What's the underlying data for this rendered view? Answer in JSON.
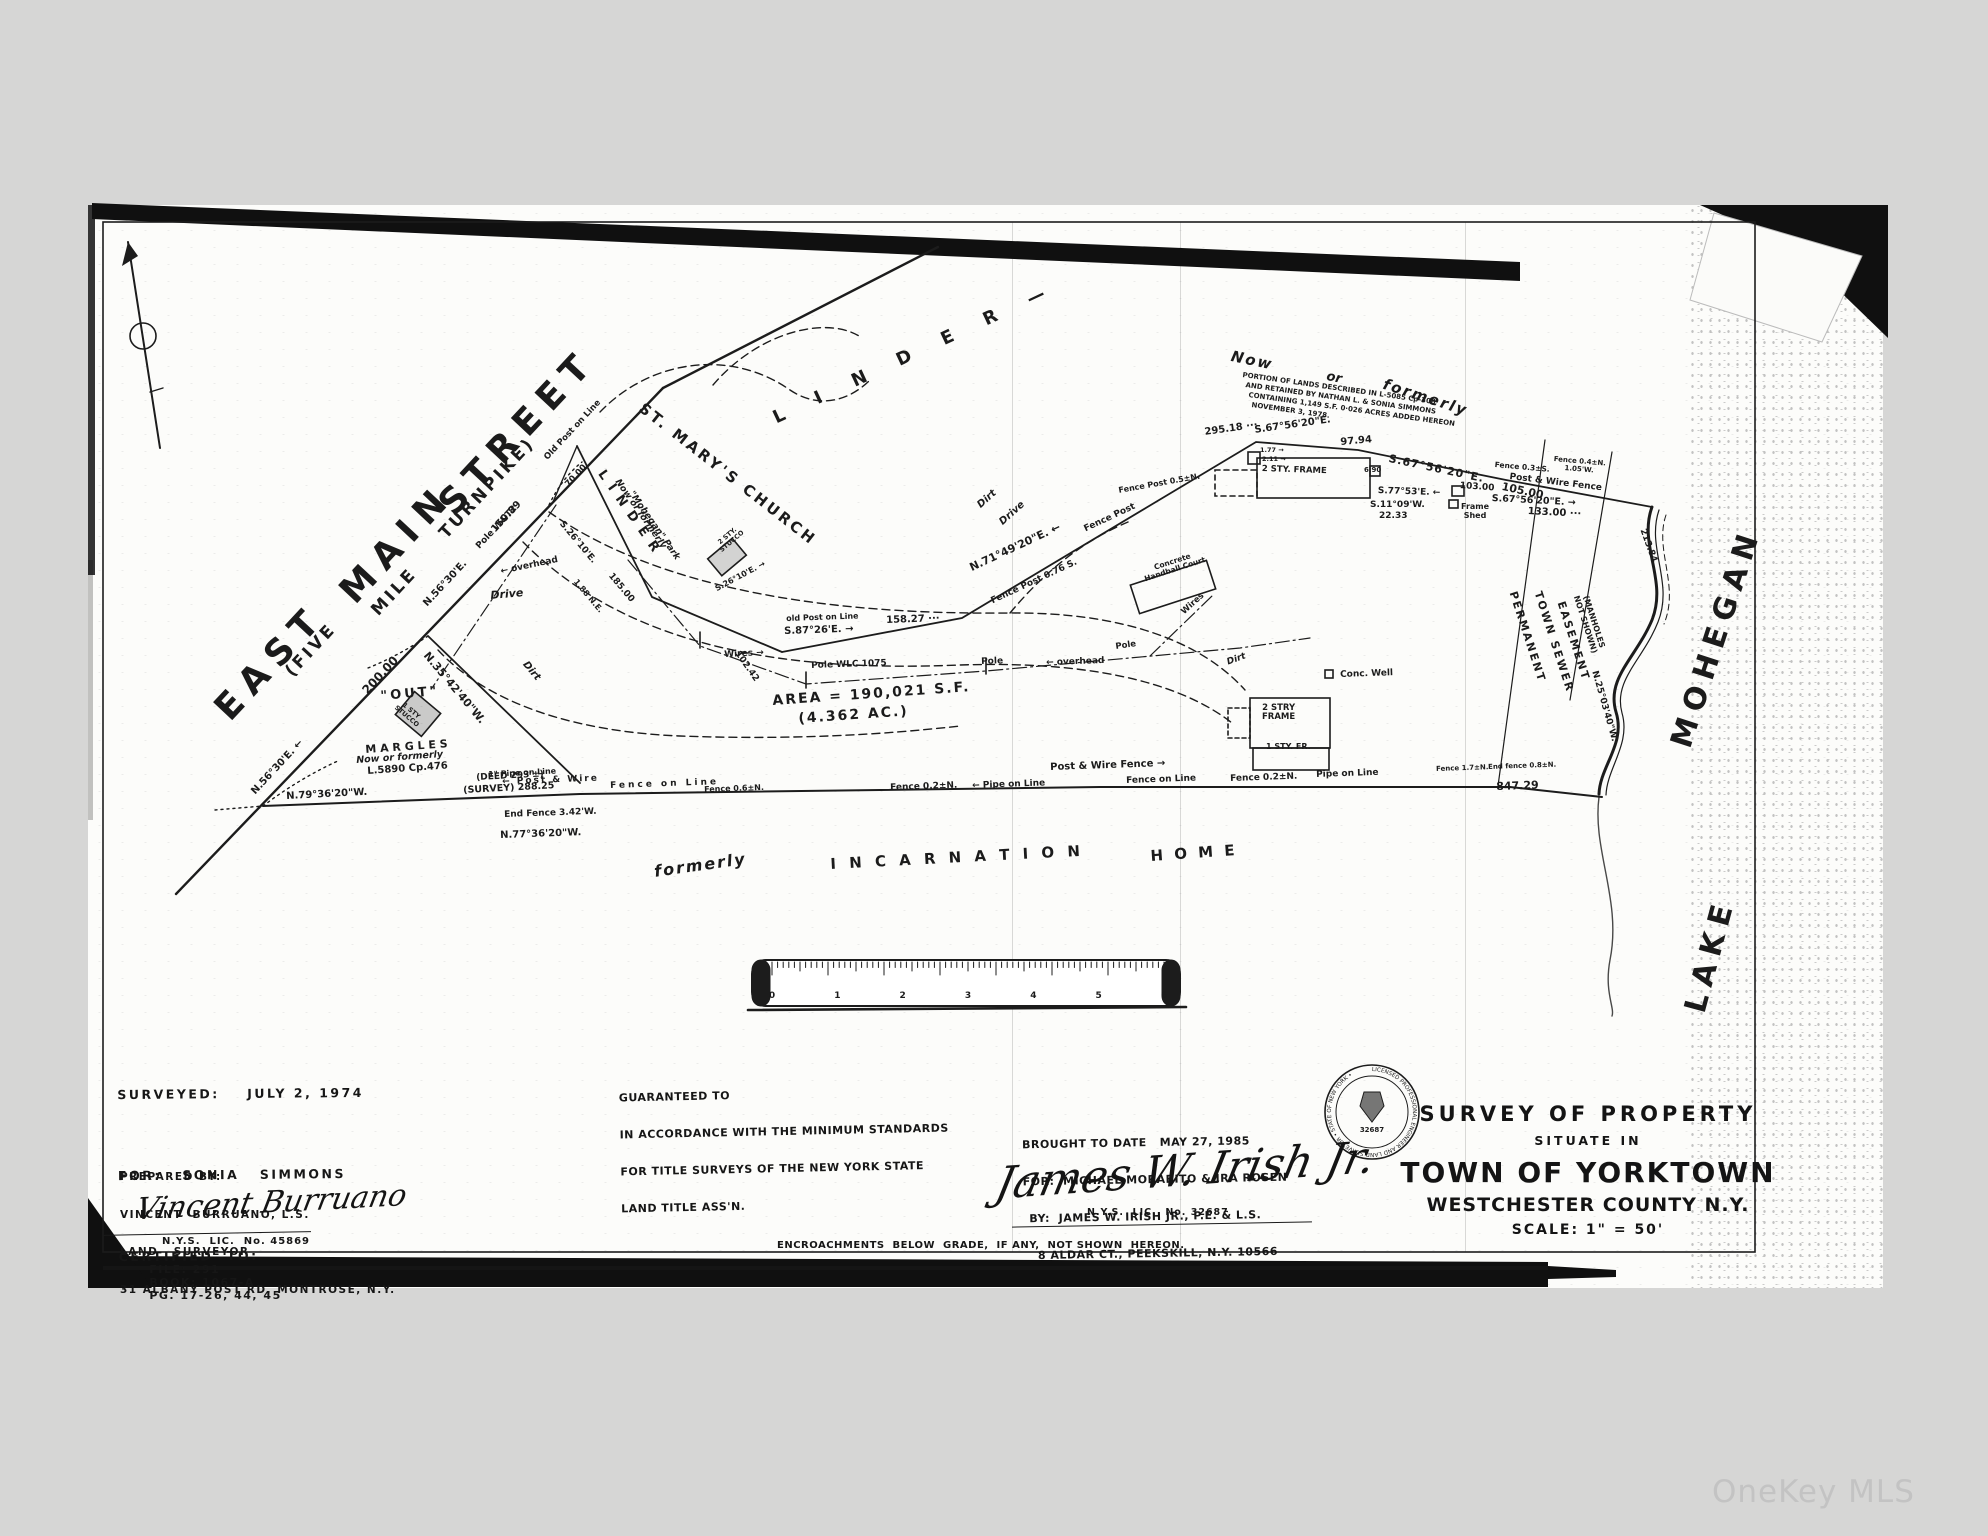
{
  "watermark": "OneKey MLS",
  "blocks": {
    "surveyed": {
      "lines": [
        "SURVEYED:    JULY 2, 1974",
        "FOR:   SONIA   SIMMONS",
        "CERTIFIED  TO:"
      ]
    },
    "prepared": {
      "lines": [
        "PREPARED BY:",
        "VINCENT  BURRUANO, L.S.",
        "LAND   SURVEYOR",
        "31 ALBANY POST RD, MONTROSE, N.Y."
      ]
    },
    "surveyor_signature": {
      "name": "Vincent Burruano",
      "license": "N.Y.S.  LIC.  No. 45869"
    },
    "file_line": {
      "file": "FILE: 291",
      "book": "BOOK: 1067-A",
      "pages": "PG. 17-26, 44, 45"
    },
    "guaranteed": {
      "lines": [
        "GUARANTEED TO",
        "IN ACCORDANCE WITH THE MINIMUM STANDARDS",
        "FOR TITLE SURVEYS OF THE NEW YORK STATE",
        "LAND TITLE ASS'N."
      ]
    },
    "brought": {
      "lines": [
        "BROUGHT TO DATE   MAY 27, 1985",
        "FOR:  MICHAEL MORABITO & IRA ROSEN",
        "BY:  JAMES W. IRISH JR., P.E. & L.S.",
        "8 ALDAR CT., PEEKSKILL, N.Y. 10566"
      ]
    },
    "engineer_signature": {
      "name": "James W. Irish Jr.",
      "license": "N.Y.S.  LIC.  No. 32687"
    },
    "encroachments_note": "ENCROACHMENTS  BELOW  GRADE,  IF ANY,  NOT SHOWN  HEREON.",
    "title": {
      "line1": "SURVEY  OF  PROPERTY",
      "line2": "SITUATE    IN",
      "line3": "TOWN  OF  YORKTOWN",
      "line4": "WESTCHESTER   COUNTY   N.Y.",
      "line5": "SCALE:  1\" =  50'"
    },
    "seal": {
      "ring_text": "LICENSED PROFESSIONAL ENGINEER AND LAND SURVEYOR • STATE OF NEW YORK •",
      "number": "32687"
    }
  },
  "ruler": {
    "numbers": [
      "0",
      "1",
      "2",
      "3",
      "4",
      "5",
      "6"
    ]
  },
  "map_labels": [
    {
      "n": "street-name-east",
      "t": "EAST",
      "x": 208,
      "y": 702,
      "r": -47,
      "s": 36,
      "ls": 10
    },
    {
      "n": "street-name-main",
      "t": "MAIN",
      "x": 333,
      "y": 585,
      "r": -47,
      "s": 36,
      "ls": 10
    },
    {
      "n": "street-name-street",
      "t": "STREET",
      "x": 432,
      "y": 497,
      "r": -47,
      "s": 36,
      "ls": 10
    },
    {
      "n": "street-sub-five",
      "t": "(FIVE",
      "x": 282,
      "y": 668,
      "r": -47,
      "s": 17,
      "ls": 3
    },
    {
      "n": "street-sub-mile",
      "t": "MILE",
      "x": 368,
      "y": 607,
      "r": -47,
      "s": 17,
      "ls": 3
    },
    {
      "n": "street-sub-turnpike",
      "t": "TURNPIKE)",
      "x": 436,
      "y": 530,
      "r": -47,
      "s": 17,
      "ls": 3
    },
    {
      "n": "bearing-label",
      "t": "N.56°30'E. ←",
      "x": 250,
      "y": 790,
      "r": -47,
      "s": 10
    },
    {
      "n": "bearing-label",
      "t": "N.56°30'E.",
      "x": 422,
      "y": 602,
      "r": -47,
      "s": 10
    },
    {
      "n": "distance-label",
      "t": "200.00",
      "x": 360,
      "y": 688,
      "r": -47,
      "s": 12
    },
    {
      "n": "pole-note",
      "t": "Pole W&T2",
      "x": 475,
      "y": 545,
      "r": -47,
      "s": 9
    },
    {
      "n": "distance-label",
      "t": "150.89",
      "x": 490,
      "y": 528,
      "r": -47,
      "s": 10
    },
    {
      "n": "bearing-label",
      "t": "N.35°42'40\"W.",
      "x": 430,
      "y": 650,
      "r": 50,
      "s": 11
    },
    {
      "n": "out-parcel-label",
      "t": "\"OUT\"",
      "x": 380,
      "y": 690,
      "r": -5,
      "s": 13,
      "ls": 3
    },
    {
      "n": "building-label-stucco1",
      "t": "1 STY\nSTUCCO",
      "x": 402,
      "y": 699,
      "r": 40,
      "s": 6.5
    },
    {
      "n": "owner-label-margles",
      "t": "M A R G L E S",
      "x": 365,
      "y": 744,
      "r": -4,
      "s": 11
    },
    {
      "n": "owner-note",
      "t": "Now  or  formerly",
      "x": 356,
      "y": 756,
      "r": -4,
      "s": 9.5,
      "i": 1
    },
    {
      "n": "deed-ref",
      "t": "L.5890  Cp.476",
      "x": 367,
      "y": 767,
      "r": -4,
      "s": 10
    },
    {
      "n": "deed-note",
      "t": "(DEED 293'±)",
      "x": 476,
      "y": 774,
      "r": -3,
      "s": 9
    },
    {
      "n": "survey-note",
      "t": "(SURVEY)  288.25",
      "x": 463,
      "y": 786,
      "r": -3,
      "s": 9.5
    },
    {
      "n": "bearing-label",
      "t": "N.79°36'20\"W.",
      "x": 286,
      "y": 792,
      "r": -3,
      "s": 10
    },
    {
      "n": "fence-note",
      "t": "End Fence 3.42'W.",
      "x": 504,
      "y": 811,
      "r": -2,
      "s": 9
    },
    {
      "n": "bearing-label",
      "t": "N.77°36'20\"W.",
      "x": 500,
      "y": 831,
      "r": -2,
      "s": 10
    },
    {
      "n": "post-note",
      "t": "Old Post on Line",
      "x": 543,
      "y": 456,
      "r": -47,
      "s": 8.5
    },
    {
      "n": "distance-label",
      "t": "70.00",
      "x": 564,
      "y": 483,
      "r": -47,
      "s": 8.5
    },
    {
      "n": "bearing-label",
      "t": "S.26°10'E.",
      "x": 564,
      "y": 520,
      "r": 50,
      "s": 9
    },
    {
      "n": "fence-note",
      "t": "1.88 N.E.",
      "x": 578,
      "y": 578,
      "r": 50,
      "s": 8
    },
    {
      "n": "distance-label",
      "t": "185.00",
      "x": 613,
      "y": 572,
      "r": 50,
      "s": 9
    },
    {
      "n": "drive-label",
      "t": "Dirt",
      "x": 528,
      "y": 660,
      "r": 50,
      "s": 10,
      "i": 1
    },
    {
      "n": "drive-label",
      "t": "Drive",
      "x": 490,
      "y": 590,
      "r": -5,
      "s": 11,
      "i": 1
    },
    {
      "n": "church-label",
      "t": "ST. MARY'S  CHURCH",
      "x": 646,
      "y": 400,
      "r": 38,
      "s": 15,
      "ls": 3
    },
    {
      "n": "owner-label-linder",
      "t": "L I N D E R",
      "x": 606,
      "y": 468,
      "r": 55,
      "s": 13,
      "ls": 2
    },
    {
      "n": "owner-note",
      "t": "Now or formerly",
      "x": 620,
      "y": 478,
      "r": 55,
      "s": 9,
      "i": 1
    },
    {
      "n": "owner-note",
      "t": "\"Mohegan\" Park",
      "x": 634,
      "y": 490,
      "r": 55,
      "s": 9,
      "i": 1
    },
    {
      "n": "building-label-stucco2",
      "t": "2 STY.\nSTUCCO",
      "x": 714,
      "y": 543,
      "r": -40,
      "s": 6.5
    },
    {
      "n": "bearing-label",
      "t": "S.26°10'E. →",
      "x": 714,
      "y": 586,
      "r": -28,
      "s": 8
    },
    {
      "n": "owner-label-linder-2",
      "t": "L  I  N  D  E  R   —",
      "x": 770,
      "y": 410,
      "r": -25,
      "s": 18,
      "ls": 14
    },
    {
      "n": "bearing-label",
      "t": "S.87°26'E. →",
      "x": 784,
      "y": 627,
      "r": -2,
      "s": 10
    },
    {
      "n": "post-note",
      "t": "old Post on Line",
      "x": 786,
      "y": 615,
      "r": -2,
      "s": 8
    },
    {
      "n": "distance-label",
      "t": "102.42",
      "x": 740,
      "y": 650,
      "r": 55,
      "s": 9
    },
    {
      "n": "wire-note",
      "t": "Wires →",
      "x": 724,
      "y": 651,
      "r": -3,
      "s": 9
    },
    {
      "n": "pole-note",
      "t": "Pole WLC 1075",
      "x": 811,
      "y": 662,
      "r": -2,
      "s": 9
    },
    {
      "n": "pole-note",
      "t": "Pole",
      "x": 981,
      "y": 658,
      "r": -2,
      "s": 9
    },
    {
      "n": "wire-note",
      "t": "← overhead",
      "x": 1046,
      "y": 659,
      "r": -2,
      "s": 9
    },
    {
      "n": "wire-note",
      "t": "← overhead",
      "x": 500,
      "y": 568,
      "r": -12,
      "s": 9
    },
    {
      "n": "area-label",
      "t": "AREA = 190,021 S.F.",
      "x": 772,
      "y": 694,
      "r": -4,
      "s": 14,
      "ls": 2
    },
    {
      "n": "area-label-acres",
      "t": "(4.362 AC.)",
      "x": 798,
      "y": 712,
      "r": -4,
      "s": 14,
      "ls": 2
    },
    {
      "n": "bearing-label",
      "t": "N.71°49'20\"E. ←",
      "x": 968,
      "y": 563,
      "r": -25,
      "s": 11
    },
    {
      "n": "fence-note",
      "t": "Fence Post",
      "x": 1083,
      "y": 526,
      "r": -25,
      "s": 9
    },
    {
      "n": "fence-note",
      "t": "Fence Post 0.76 S.",
      "x": 990,
      "y": 598,
      "r": -25,
      "s": 9
    },
    {
      "n": "distance-label",
      "t": "158.27 ···",
      "x": 886,
      "y": 616,
      "r": -2,
      "s": 10
    },
    {
      "n": "handball-label",
      "t": "Concrete\nHandball Court",
      "x": 1141,
      "y": 568,
      "r": -18,
      "s": 7.5
    },
    {
      "n": "wire-note",
      "t": "Wires",
      "x": 1180,
      "y": 610,
      "r": -42,
      "s": 8.5
    },
    {
      "n": "pole-note",
      "t": "Pole",
      "x": 1115,
      "y": 643,
      "r": -8,
      "s": 8.5
    },
    {
      "n": "drive-label",
      "t": "Dirt",
      "x": 976,
      "y": 503,
      "r": -42,
      "s": 10,
      "i": 1
    },
    {
      "n": "drive-label",
      "t": "Drive",
      "x": 998,
      "y": 520,
      "r": -42,
      "s": 10,
      "i": 1
    },
    {
      "n": "owner-note",
      "t": "Now",
      "x": 1233,
      "y": 348,
      "r": 12,
      "s": 15,
      "i": 1,
      "ls": 2
    },
    {
      "n": "owner-note",
      "t": "or",
      "x": 1328,
      "y": 370,
      "r": 12,
      "s": 13,
      "i": 1
    },
    {
      "n": "owner-note",
      "t": "formerly",
      "x": 1386,
      "y": 376,
      "r": 18,
      "s": 15,
      "i": 1,
      "ls": 2
    },
    {
      "n": "parcel-note",
      "t": "PORTION OF LANDS DESCRIBED IN L-5085 Cp-308",
      "x": 1243,
      "y": 372,
      "r": 8,
      "s": 7
    },
    {
      "n": "parcel-note",
      "t": "AND RETAINED BY NATHAN L. & SONIA SIMMONS",
      "x": 1246,
      "y": 382,
      "r": 8,
      "s": 7
    },
    {
      "n": "parcel-note",
      "t": "CONTAINING 1,149 S.F.  0·026 ACRES ADDED HEREON",
      "x": 1249,
      "y": 392,
      "r": 8,
      "s": 7
    },
    {
      "n": "parcel-note",
      "t": "NOVEMBER 3, 1978.",
      "x": 1252,
      "y": 402,
      "r": 8,
      "s": 7
    },
    {
      "n": "distance-label",
      "t": "295.18 ···",
      "x": 1204,
      "y": 428,
      "r": -8,
      "s": 10
    },
    {
      "n": "bearing-label",
      "t": "S.67°56'20\"E.",
      "x": 1254,
      "y": 426,
      "r": -8,
      "s": 10
    },
    {
      "n": "distance-label",
      "t": "97.94",
      "x": 1340,
      "y": 438,
      "r": -5,
      "s": 10
    },
    {
      "n": "bearing-label",
      "t": "S.67°56'20\"E.",
      "x": 1390,
      "y": 453,
      "r": 12,
      "s": 11,
      "ls": 1
    },
    {
      "n": "distance-label",
      "t": "105.00",
      "x": 1503,
      "y": 481,
      "r": 12,
      "s": 11
    },
    {
      "n": "distance-label",
      "t": "103.00",
      "x": 1460,
      "y": 482,
      "r": 4,
      "s": 9
    },
    {
      "n": "bearing-label",
      "t": "S.77°53'E. ←",
      "x": 1378,
      "y": 487,
      "r": 2,
      "s": 9
    },
    {
      "n": "bearing-label",
      "t": "S.11°09'W.",
      "x": 1370,
      "y": 501,
      "r": 0,
      "s": 9
    },
    {
      "n": "distance-label",
      "t": "22.33",
      "x": 1379,
      "y": 512,
      "r": 0,
      "s": 9
    },
    {
      "n": "building-label-frame1",
      "t": "2 STY. FRAME",
      "x": 1262,
      "y": 465,
      "r": 2,
      "s": 8.5
    },
    {
      "n": "building-label-shed",
      "t": "Frame\nShed",
      "x": 1461,
      "y": 503,
      "r": 0,
      "s": 8
    },
    {
      "n": "offset-note",
      "t": "1.77 →",
      "x": 1260,
      "y": 447,
      "r": 0,
      "s": 6.5
    },
    {
      "n": "offset-note",
      "t": "2.11 →",
      "x": 1262,
      "y": 456,
      "r": 0,
      "s": 6.5
    },
    {
      "n": "offset-note",
      "t": "6.90",
      "x": 1364,
      "y": 467,
      "r": 0,
      "s": 7
    },
    {
      "n": "fence-note",
      "t": "Fence 0.3±S.",
      "x": 1495,
      "y": 461,
      "r": 5,
      "s": 7.5
    },
    {
      "n": "fence-note",
      "t": "Fence 0.4±N.\n1.05'W.",
      "x": 1554,
      "y": 456,
      "r": 5,
      "s": 7
    },
    {
      "n": "fence-note",
      "t": "Post & Wire Fence",
      "x": 1510,
      "y": 473,
      "r": 7,
      "s": 9
    },
    {
      "n": "bearing-label",
      "t": "S.67°56'20\"E. →",
      "x": 1492,
      "y": 494,
      "r": 3,
      "s": 9.5
    },
    {
      "n": "distance-label",
      "t": "133.00 ···",
      "x": 1528,
      "y": 507,
      "r": 3,
      "s": 10
    },
    {
      "n": "distance-label",
      "t": "213.84",
      "x": 1646,
      "y": 528,
      "r": 70,
      "s": 9
    },
    {
      "n": "easement-label",
      "t": "PERMANENT",
      "x": 1518,
      "y": 590,
      "r": 72,
      "s": 11,
      "ls": 2
    },
    {
      "n": "easement-label",
      "t": "TOWN  SEWER",
      "x": 1543,
      "y": 590,
      "r": 72,
      "s": 11,
      "ls": 2
    },
    {
      "n": "easement-label",
      "t": "EASEMENT",
      "x": 1566,
      "y": 600,
      "r": 72,
      "s": 11,
      "ls": 2
    },
    {
      "n": "easement-label",
      "t": "(MANHOLES\nNOT SHOWN)",
      "x": 1588,
      "y": 592,
      "r": 72,
      "s": 8
    },
    {
      "n": "bearing-label",
      "t": "N.25°03'40\"W.",
      "x": 1598,
      "y": 670,
      "r": 74,
      "s": 9
    },
    {
      "n": "lake-name-mohegan",
      "t": "MOHEGAN",
      "x": 1666,
      "y": 742,
      "r": -72,
      "s": 30,
      "ls": 8
    },
    {
      "n": "lake-name-lake",
      "t": "LAKE",
      "x": 1680,
      "y": 1008,
      "r": -75,
      "s": 30,
      "ls": 8
    },
    {
      "n": "distance-label",
      "t": "847.29",
      "x": 1496,
      "y": 781,
      "r": -2,
      "s": 11
    },
    {
      "n": "fence-note",
      "t": "End fence 0.8±N.",
      "x": 1488,
      "y": 764,
      "r": -2,
      "s": 7
    },
    {
      "n": "fence-note",
      "t": "Fence 1.7±N.",
      "x": 1436,
      "y": 766,
      "r": -2,
      "s": 7
    },
    {
      "n": "fence-note",
      "t": "Post  &  Wire  Fence →",
      "x": 1050,
      "y": 763,
      "r": -2,
      "s": 10
    },
    {
      "n": "fence-note",
      "t": "Fence on Line",
      "x": 1126,
      "y": 777,
      "r": -2,
      "s": 9
    },
    {
      "n": "fence-note",
      "t": "Pipe on Line",
      "x": 1316,
      "y": 771,
      "r": -2,
      "s": 9
    },
    {
      "n": "fence-note",
      "t": "Fence 0.2±N.",
      "x": 1230,
      "y": 775,
      "r": -2,
      "s": 9
    },
    {
      "n": "fence-note",
      "t": "← Pipe on Line",
      "x": 972,
      "y": 782,
      "r": -2,
      "s": 9
    },
    {
      "n": "fence-note",
      "t": "Fence 0.2±N.",
      "x": 890,
      "y": 784,
      "r": -2,
      "s": 9
    },
    {
      "n": "fence-note",
      "t": "Fence   on   Line",
      "x": 610,
      "y": 782,
      "r": -2,
      "s": 9,
      "ls": 3
    },
    {
      "n": "fence-note",
      "t": "← Post  &  Wire",
      "x": 502,
      "y": 778,
      "r": -2,
      "s": 9,
      "ls": 2
    },
    {
      "n": "fence-note",
      "t": "1\" Pipe on Line",
      "x": 488,
      "y": 771,
      "r": -3,
      "s": 8
    },
    {
      "n": "fence-note",
      "t": "Fence 0.6±N.",
      "x": 704,
      "y": 786,
      "r": -2,
      "s": 8
    },
    {
      "n": "former-owner",
      "t": "formerly",
      "x": 653,
      "y": 863,
      "r": -8,
      "s": 16,
      "i": 1,
      "ls": 2
    },
    {
      "n": "former-owner",
      "t": "I N C A R N A T I O N",
      "x": 830,
      "y": 856,
      "r": -3,
      "s": 15,
      "ls": 4
    },
    {
      "n": "former-owner",
      "t": "H O M E",
      "x": 1150,
      "y": 848,
      "r": -4,
      "s": 15,
      "ls": 3
    },
    {
      "n": "well-note",
      "t": "Conc. Well",
      "x": 1340,
      "y": 671,
      "r": -2,
      "s": 9
    },
    {
      "n": "building-label-frame2",
      "t": "2 STRY\nFRAME",
      "x": 1262,
      "y": 704,
      "r": 0,
      "s": 8.5
    },
    {
      "n": "building-label-frame2b",
      "t": "1 STY. FR.",
      "x": 1266,
      "y": 743,
      "r": 0,
      "s": 8
    },
    {
      "n": "drive-label",
      "t": "Dirt",
      "x": 1226,
      "y": 659,
      "r": -20,
      "s": 9,
      "i": 1
    },
    {
      "n": "fence-note",
      "t": "Fence Post 0.5±N.",
      "x": 1118,
      "y": 487,
      "r": -10,
      "s": 8
    }
  ]
}
